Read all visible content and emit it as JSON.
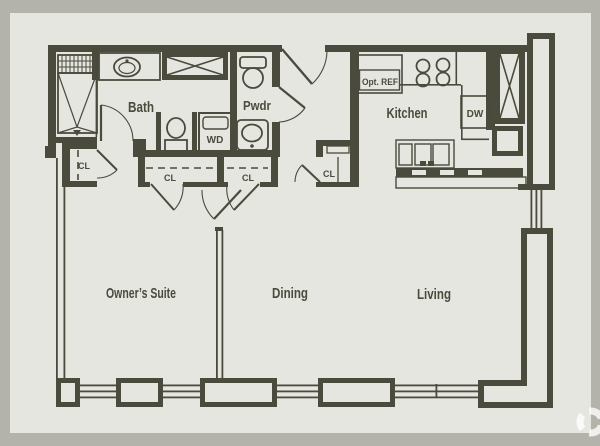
{
  "colors": {
    "wall": "#4a4a3d",
    "floor": "#e6e6e1",
    "frame": "#b3b3ab",
    "watermark": "#ffffff"
  },
  "rooms": {
    "bath": "Bath",
    "powder": "Pwdr",
    "kitchen": "Kitchen",
    "owners_suite": "Owner’s Suite",
    "dining": "Dining",
    "living": "Living"
  },
  "fixtures": {
    "washer_dryer": "WD",
    "dishwasher": "DW",
    "optional_refrigerator": "Opt. REF"
  },
  "closets": {
    "bath_closet": "CL",
    "hall_closet_left": "CL",
    "hall_closet_right": "CL",
    "entry_closet": "CL"
  }
}
